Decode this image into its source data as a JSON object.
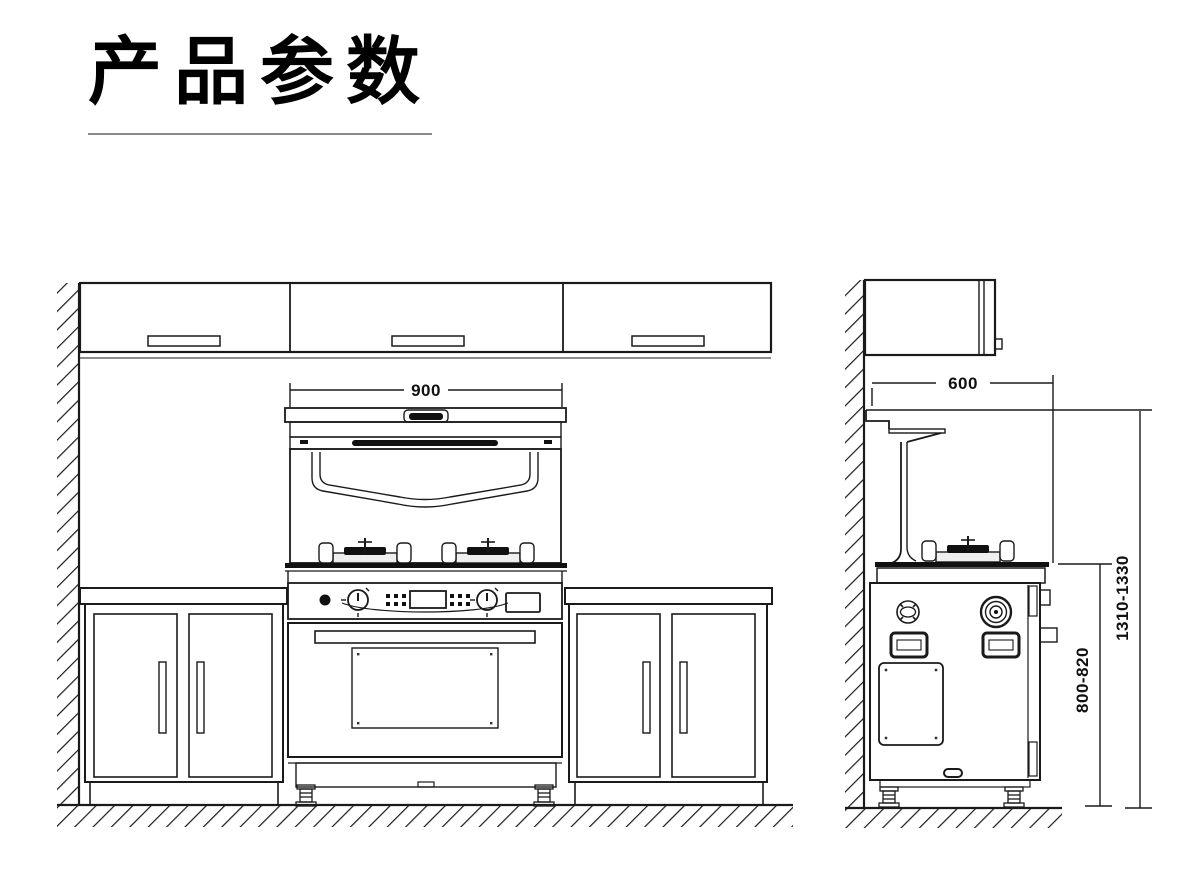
{
  "header": {
    "title": "产品参数"
  },
  "front_view": {
    "name": "integrated-stove-front-elevation",
    "width_label": "900"
  },
  "side_view": {
    "name": "integrated-stove-side-elevation",
    "depth_label": "600",
    "counter_height_label": "800-820",
    "total_height_label": "1310-1330"
  },
  "colors": {
    "line": "#1a1a1a",
    "underline": "#8a8a8a",
    "background": "#ffffff"
  }
}
